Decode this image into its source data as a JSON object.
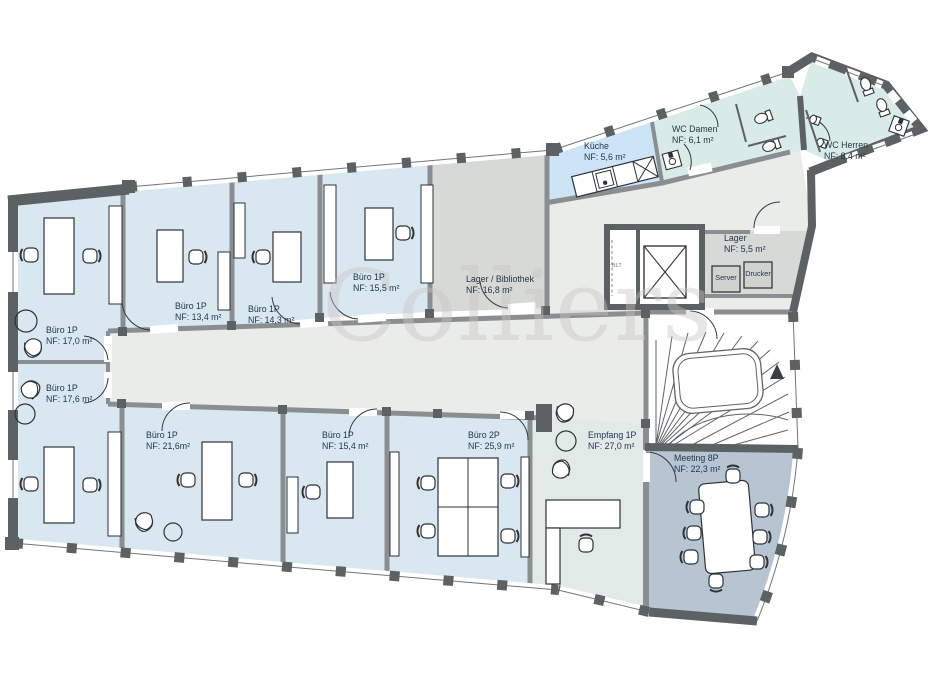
{
  "watermark": "Colliers",
  "palette": {
    "office": "#d9e7f1",
    "kitchen": "#cde4f6",
    "wc": "#d9ebe7",
    "storage": "#d6d9d6",
    "meeting": "#b7c5d2",
    "reception": "#e2eae8",
    "corridor": "#eaece9",
    "wall_dark": "#5c6163",
    "wall_mid": "#8a8e90",
    "label_text": "#22364e"
  },
  "rooms": {
    "buero_17_0": {
      "name": "Büro 1P",
      "area": "NF: 17,0 m²"
    },
    "buero_17_6": {
      "name": "Büro 1P",
      "area": "NF: 17,6 m²"
    },
    "buero_13_4": {
      "name": "Büro 1P",
      "area": "NF: 13,4 m²"
    },
    "buero_14_3": {
      "name": "Büro 1P",
      "area": "NF: 14,3 m²"
    },
    "buero_15_5": {
      "name": "Büro 1P",
      "area": "NF: 15,5 m²"
    },
    "lager_bibliothek": {
      "name": "Lager / Bibliothek",
      "area": "NF: 16,8 m²"
    },
    "kueche": {
      "name": "Küche",
      "area": "NF: 5,6 m²"
    },
    "wc_damen": {
      "name": "WC Damen",
      "area": "NF: 6,1 m²"
    },
    "wc_herren": {
      "name": "WC Herren",
      "area": "NF: 8,4 m²"
    },
    "lager": {
      "name": "Lager",
      "area": "NF: 5,5 m²"
    },
    "buero_21_6": {
      "name": "Büro 1P",
      "area": "NF: 21,6m²"
    },
    "buero_15_4": {
      "name": "Büro 1P",
      "area": "NF: 15,4 m²"
    },
    "buero_2p": {
      "name": "Büro 2P",
      "area": "NF: 25,9 m²"
    },
    "empfang": {
      "name": "Empfang 1P",
      "area": "NF: 27,0 m²"
    },
    "meeting": {
      "name": "Meeting 8P",
      "area": "NF: 22,3 m²"
    }
  },
  "equipment": {
    "server": "Server",
    "drucker": "Drucker",
    "blt": "BLT"
  }
}
